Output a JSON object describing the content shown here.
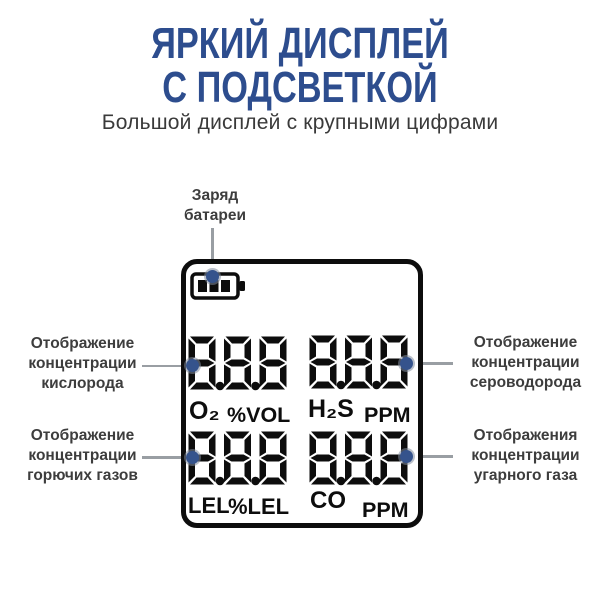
{
  "title": {
    "line1": "ЯРКИЙ ДИСПЛЕЙ",
    "line2": "С ПОДСВЕТКОЙ"
  },
  "subtitle": "Большой дисплей с крупными цифрами",
  "callouts": {
    "battery": "Заряд\nбатареи",
    "left_top": "Отображение\nконцентрации\nкислорода",
    "left_bottom": "Отображение\nконцентрации\nгорючих газов",
    "right_top": "Отображение\nконцентрации\nсероводорода",
    "right_bottom": "Отображения\nконцентрации\nугарного газа"
  },
  "display": {
    "battery_icon": "battery-level-icon",
    "rows": [
      {
        "left_value": "8.8.8",
        "left_gas": "O₂",
        "left_scale": "%VOL",
        "right_value": "8.8.8",
        "right_gas": "H₂S",
        "right_scale": "PPM"
      },
      {
        "left_value": "8.8.8",
        "left_gas": "LEL",
        "left_scale": "%LEL",
        "right_value": "8.8.8",
        "right_gas": "CO",
        "right_scale": "PPM"
      }
    ]
  },
  "colors": {
    "accent_blue": "#2d4d8e",
    "dot_blue": "#35538c",
    "line_gray": "#999ea3",
    "label_gray": "#3d3d3d",
    "lcd_black": "#0d0d0d"
  }
}
